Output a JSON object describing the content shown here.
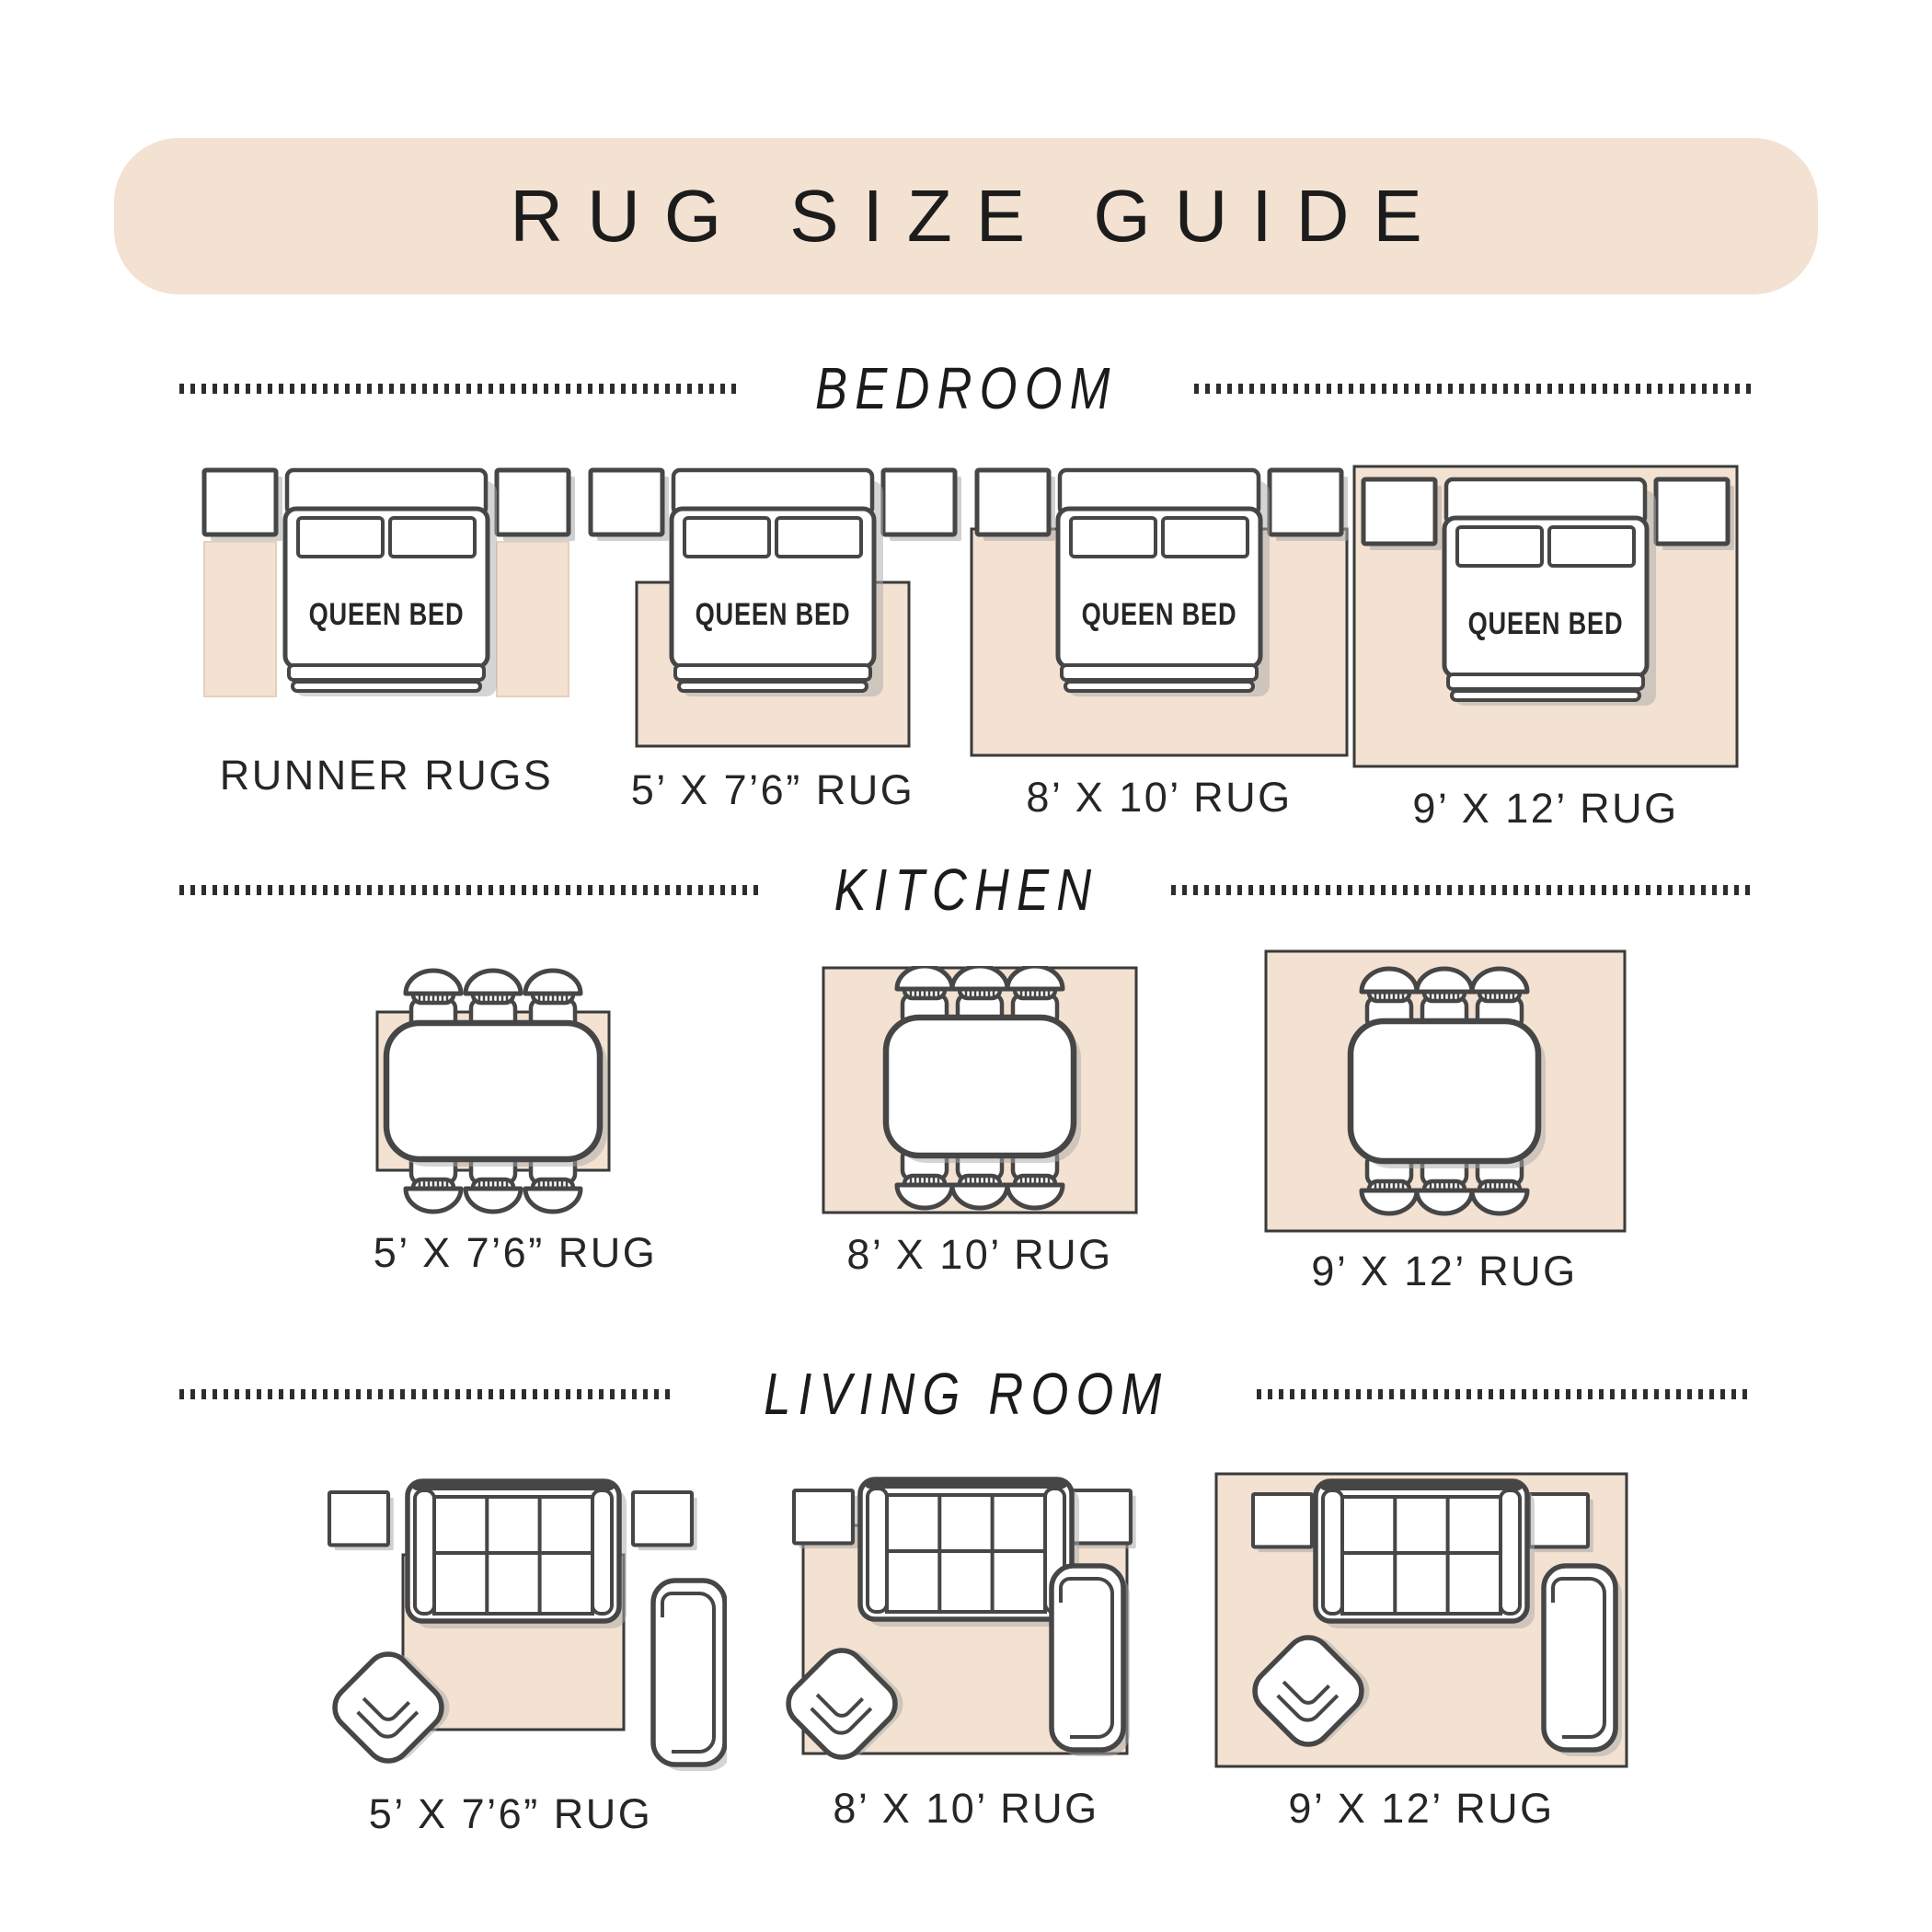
{
  "header": {
    "title": "RUG SIZE GUIDE"
  },
  "bed_label": "QUEEN BED",
  "sections": {
    "bedroom": {
      "title": "BEDROOM",
      "labels": [
        "RUNNER RUGS",
        "5’ X 7’6” RUG",
        "8’ X 10’ RUG",
        "9’ X 12’ RUG"
      ]
    },
    "kitchen": {
      "title": "KITCHEN",
      "labels": [
        "5’ X 7’6” RUG",
        "8’ X 10’ RUG",
        "9’ X 12’ RUG"
      ]
    },
    "living_room": {
      "title": "LIVING ROOM",
      "labels": [
        "5’ X 7’6” RUG",
        "8’ X 10’ RUG",
        "9’ X 12’ RUG"
      ]
    }
  },
  "colors": {
    "beige": "#f3e1d1",
    "furniture_outline": "#464646",
    "rug_border": "#3a3a3a",
    "title_text": "#1c1c1c",
    "label_text": "#262626"
  }
}
